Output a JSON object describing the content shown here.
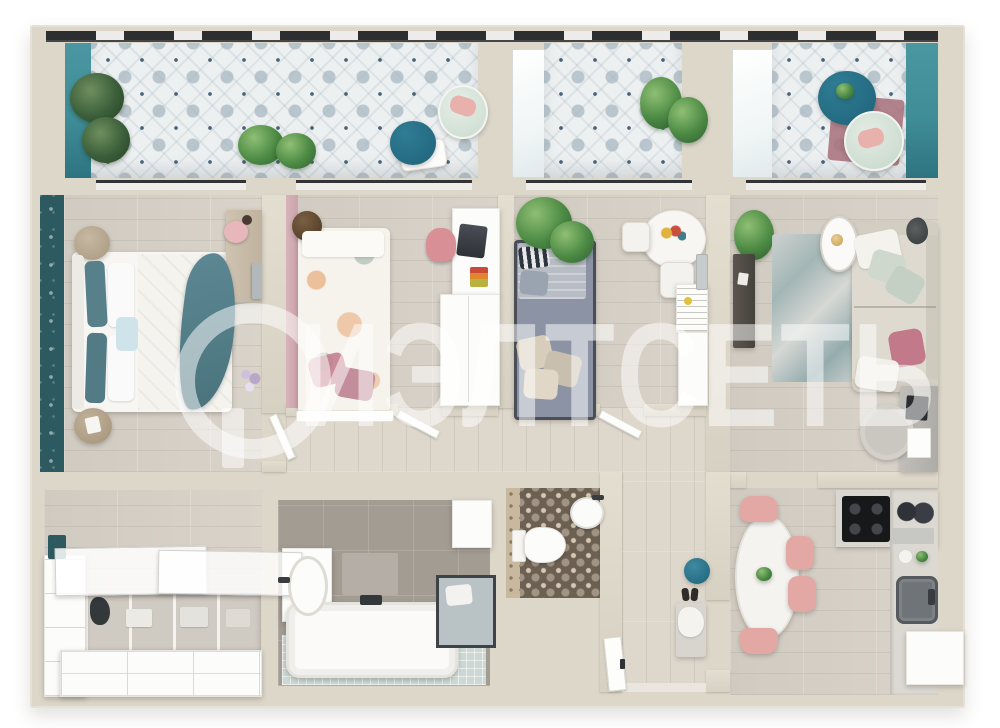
{
  "watermark": {
    "text": "ИЭЛТСЕТЬ",
    "logo": "circled-letter-monogram"
  },
  "palette": {
    "wall": "#dcd7c9",
    "wood": "#d7d1c7",
    "tile_base": "#edf0f1",
    "tile_accent": "#2b4a62",
    "teal_accent": "#3f8d97",
    "wallpaper_teal": "#2d5a60",
    "table_navy": "#1f6279",
    "chair_pink": "#e3a8a4",
    "pillow_pink": "#c2798a",
    "bed_gray": "#8b93a4",
    "sofa_beige": "#dedacf",
    "bath_tile": "#a39c93",
    "wc_tile": "#6c6053",
    "mosaic_mint": "#ccd8d3",
    "plant_green": "#4c8a44",
    "counter_gray": "#d9d7d0",
    "cooktop_black": "#17181a",
    "watermark_white": "rgba(255,255,255,0.52)"
  },
  "scene": {
    "type": "apartment-floor-plan-3d-top-view",
    "rooms": [
      {
        "id": "balcony-left",
        "furniture": [
          "plants",
          "round-tea-table",
          "lounge-chair",
          "mat"
        ]
      },
      {
        "id": "balcony-middle",
        "furniture": [
          "plants",
          "glass-screen"
        ]
      },
      {
        "id": "balcony-right",
        "furniture": [
          "round-tea-table",
          "lounge-chair",
          "rug",
          "glass-screen"
        ]
      },
      {
        "id": "master-bedroom",
        "furniture": [
          "double-bed",
          "teal-throw",
          "nightstand",
          "nightstand",
          "vanity-desk",
          "stool",
          "wall-tv",
          "flowers"
        ]
      },
      {
        "id": "kids-bedroom",
        "furniture": [
          "single-bed-floral",
          "pouf",
          "desk",
          "laptop",
          "chair",
          "books",
          "wardrobe"
        ]
      },
      {
        "id": "nursery-bedroom",
        "furniture": [
          "gray-bed",
          "plant",
          "round-table",
          "chair",
          "chair",
          "crib",
          "wardrobe",
          "wall-frame"
        ]
      },
      {
        "id": "living-room",
        "furniture": [
          "sofa",
          "pillows",
          "coffee-table",
          "table-lamp",
          "floor-lamp",
          "rug",
          "tv-console",
          "plant",
          "desk",
          "chair"
        ]
      },
      {
        "id": "corridor",
        "furniture": [
          "doors"
        ]
      },
      {
        "id": "storage-room",
        "furniture": [
          "sliding-glass-doors",
          "open-shelf-unit",
          "coat",
          "drawer-unit",
          "side-cabinets"
        ]
      },
      {
        "id": "bathroom",
        "furniture": [
          "bathtub",
          "sink-vanity",
          "shower",
          "door",
          "mat"
        ]
      },
      {
        "id": "wc",
        "furniture": [
          "toilet",
          "corner-sink"
        ]
      },
      {
        "id": "hallway",
        "furniture": [
          "teal-pouf",
          "shoes",
          "bench-with-clothes",
          "entry-door"
        ]
      },
      {
        "id": "kitchen-dining",
        "furniture": [
          "oval-dining-table",
          "chair",
          "chair",
          "chair",
          "chair",
          "cooktop",
          "counter",
          "appliances",
          "sink",
          "fridge"
        ]
      }
    ]
  }
}
